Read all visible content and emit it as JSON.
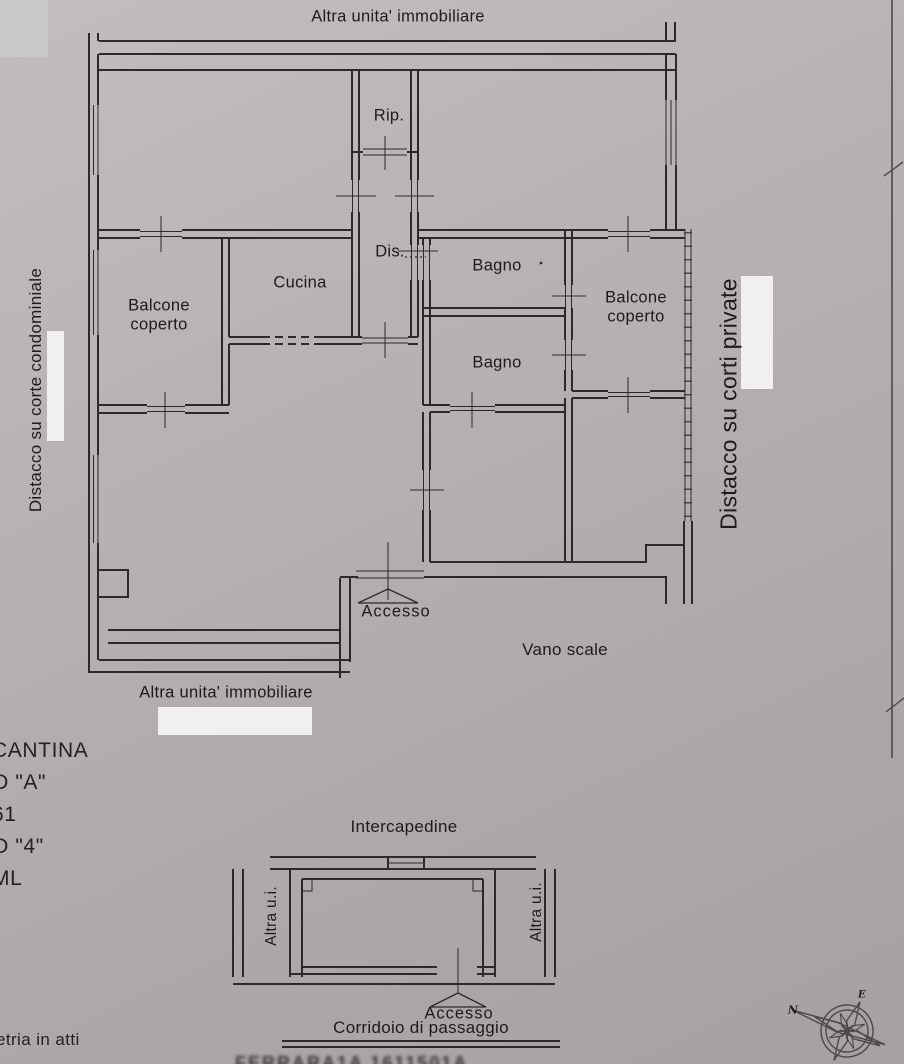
{
  "colors": {
    "paper": "#b3afb0",
    "ink": "#262425",
    "redaction_white": "#f1eff0",
    "corner_gray": "#c9c7c8"
  },
  "main_plan": {
    "top_label": "Altra unita' immobiliare",
    "bottom_label": "Altra unita' immobiliare",
    "left_label": "Distacco su corte condominiale",
    "right_label": "Distacco su corti private",
    "rooms": {
      "rip": "Rip.",
      "dis": "Dis.",
      "cucina": "Cucina",
      "bagno_top": "Bagno",
      "bagno_bottom": "Bagno",
      "balcone_left": "Balcone coperto",
      "balcone_right": "Balcone coperto",
      "accesso": "Accesso",
      "vano_scale": "Vano scale"
    }
  },
  "cantina_plan": {
    "title": "Intercapedine",
    "left_label": "Altra u.i.",
    "right_label": "Altra u.i.",
    "accesso": "Accesso",
    "bottom_label": "Corridoio di passaggio"
  },
  "left_column": {
    "lines": [
      "CANTINA",
      "O \"A\"",
      "61",
      "O \"4\"",
      "ML"
    ],
    "bottom_note": "etria in atti"
  },
  "artifacts": {
    "bottom_blur_text": "FERRARA1A 1611501A"
  },
  "compass": {
    "north": "N",
    "east": "E"
  }
}
